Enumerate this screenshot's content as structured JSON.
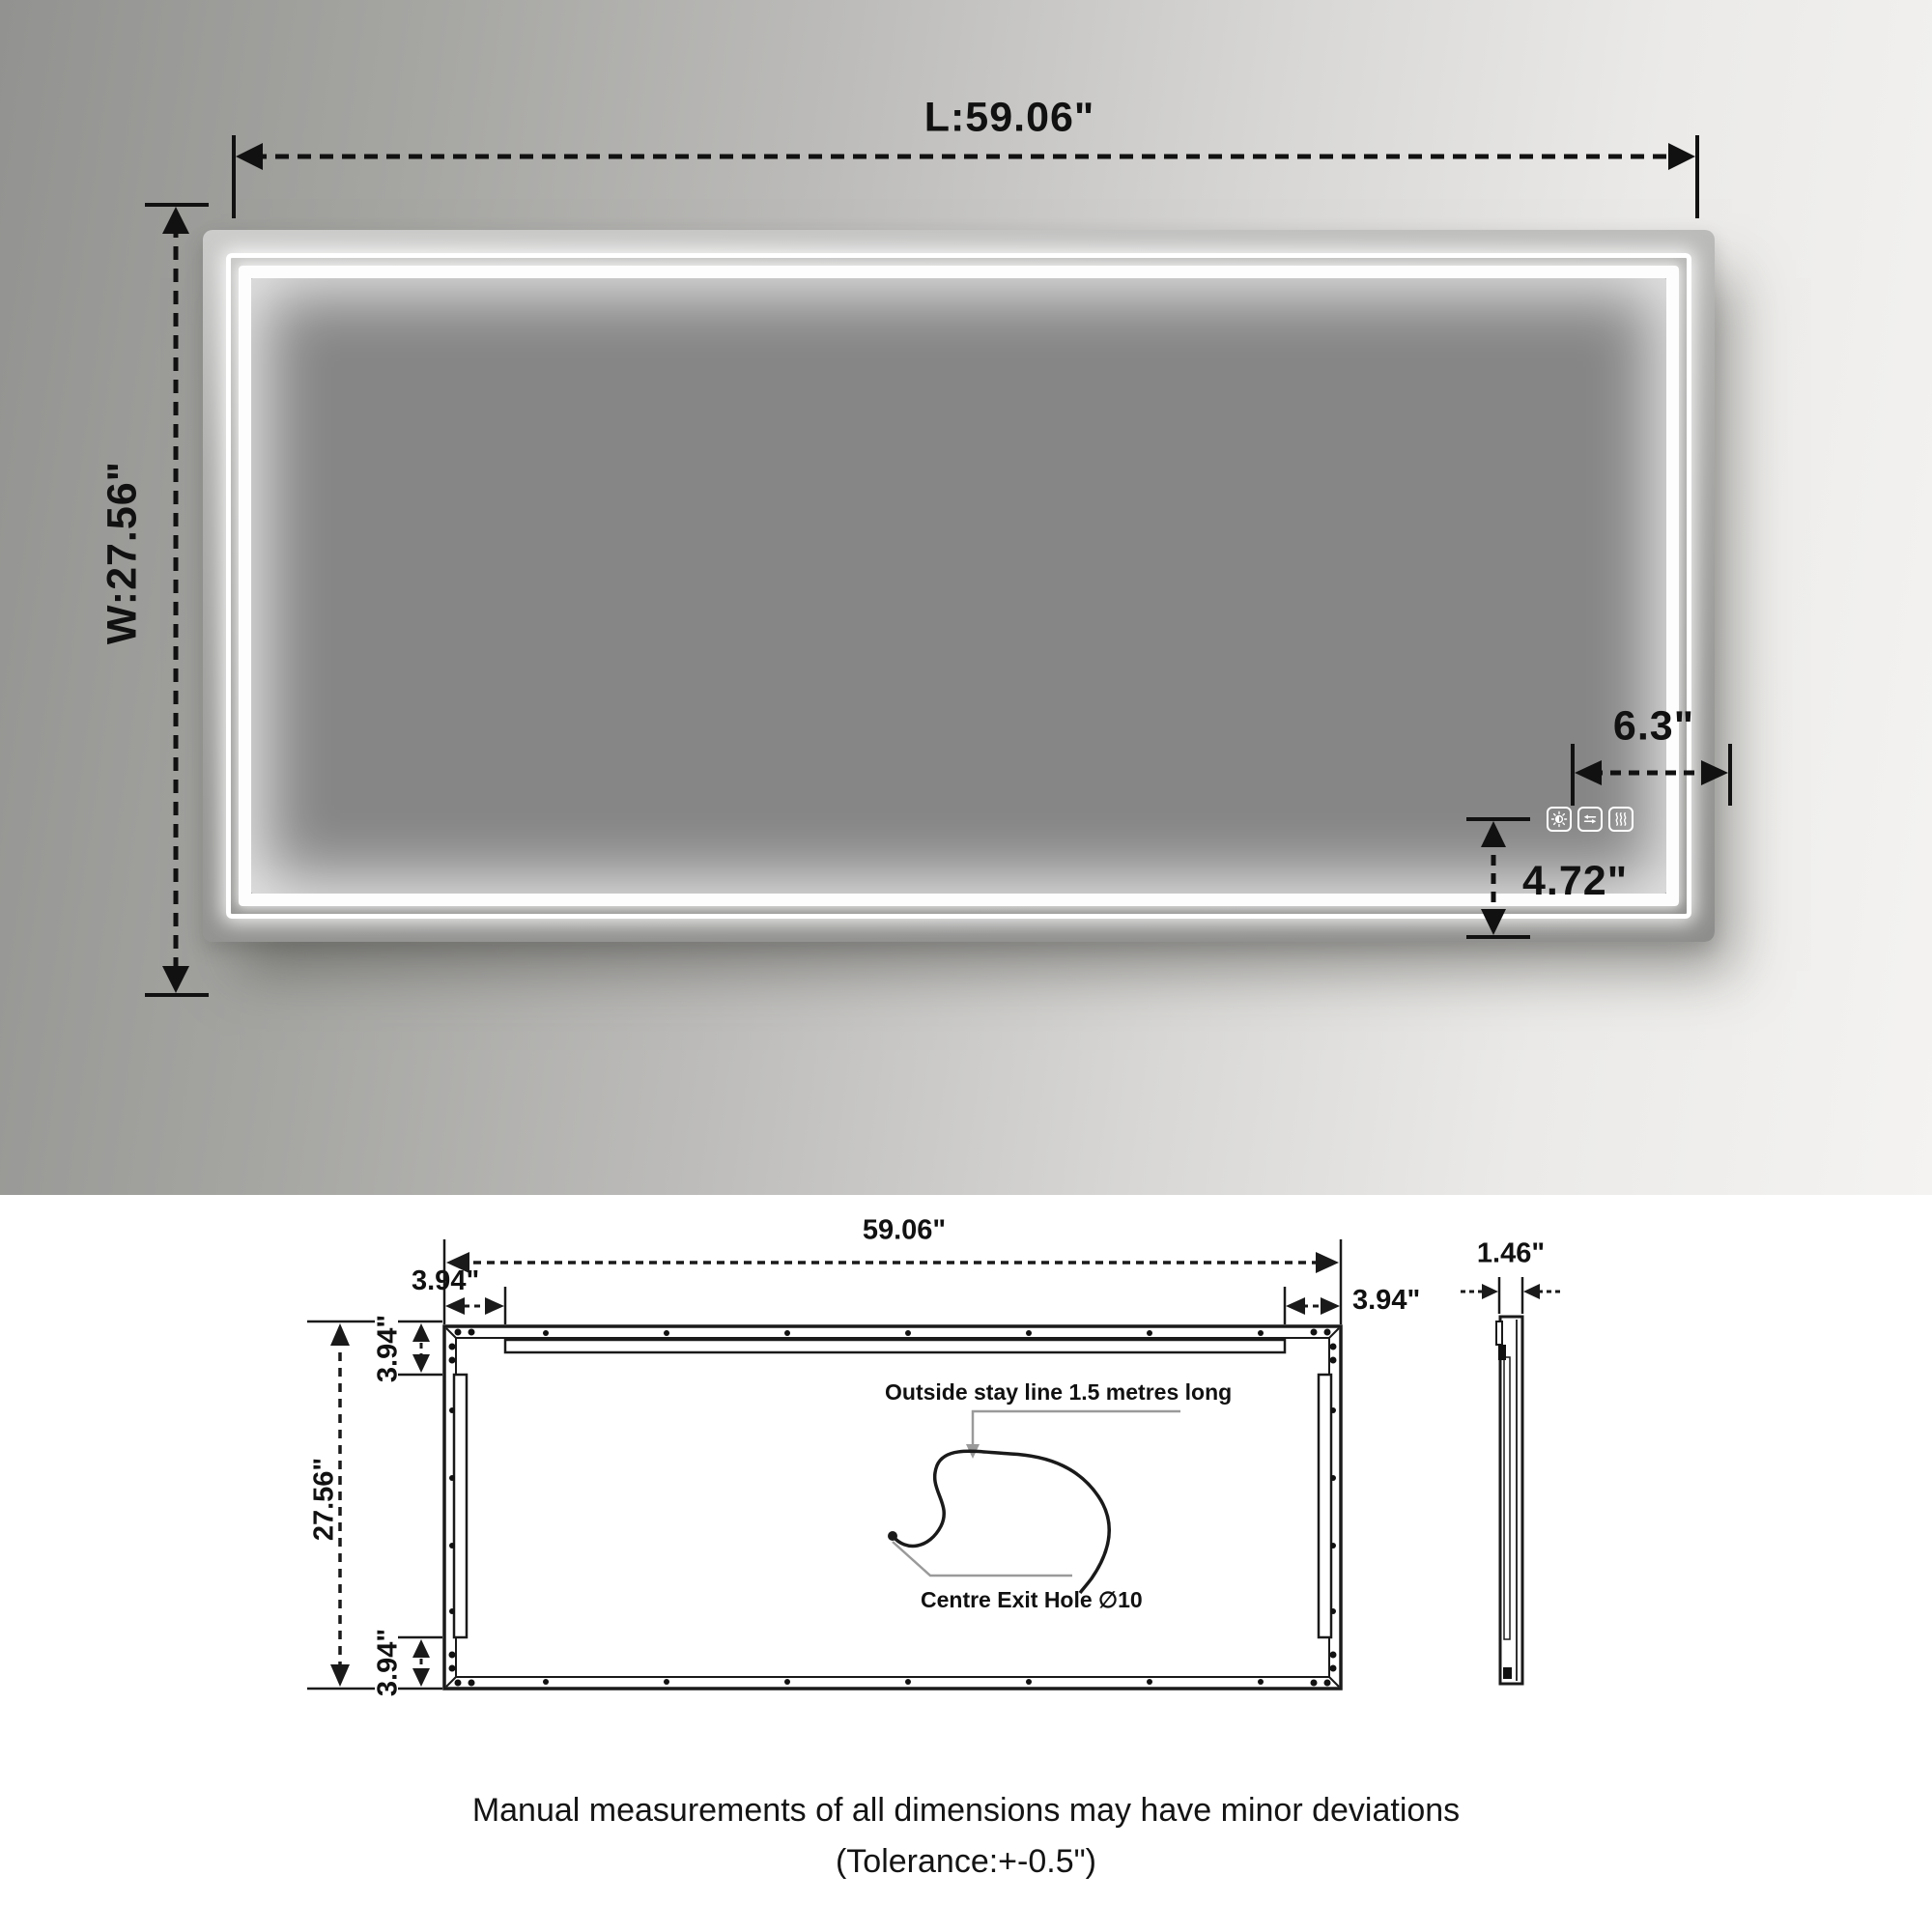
{
  "photo": {
    "length_label": "L:59.06\"",
    "width_label": "W:27.56\"",
    "controls_offset_x_label": "6.3\"",
    "controls_offset_y_label": "4.72\""
  },
  "drawing": {
    "length_label": "59.06\"",
    "margin_left_label": "3.94\"",
    "margin_right_label": "3.94\"",
    "height_label": "27.56\"",
    "margin_top_label": "3.94\"",
    "margin_bottom_label": "3.94\"",
    "depth_label": "1.46\"",
    "stay_line_note": "Outside stay line 1.5 metres long",
    "exit_hole_note": "Centre Exit Hole ∅10"
  },
  "footer": {
    "line1": "Manual measurements of all dimensions may have minor deviations",
    "line2": "(Tolerance:+-0.5\")"
  },
  "colors": {
    "dimension_line": "#111111",
    "drawing_line": "#1a1a1a",
    "leader_line": "#9a9a9a",
    "led_white": "#ffffff",
    "mirror_surface": "#868686"
  }
}
